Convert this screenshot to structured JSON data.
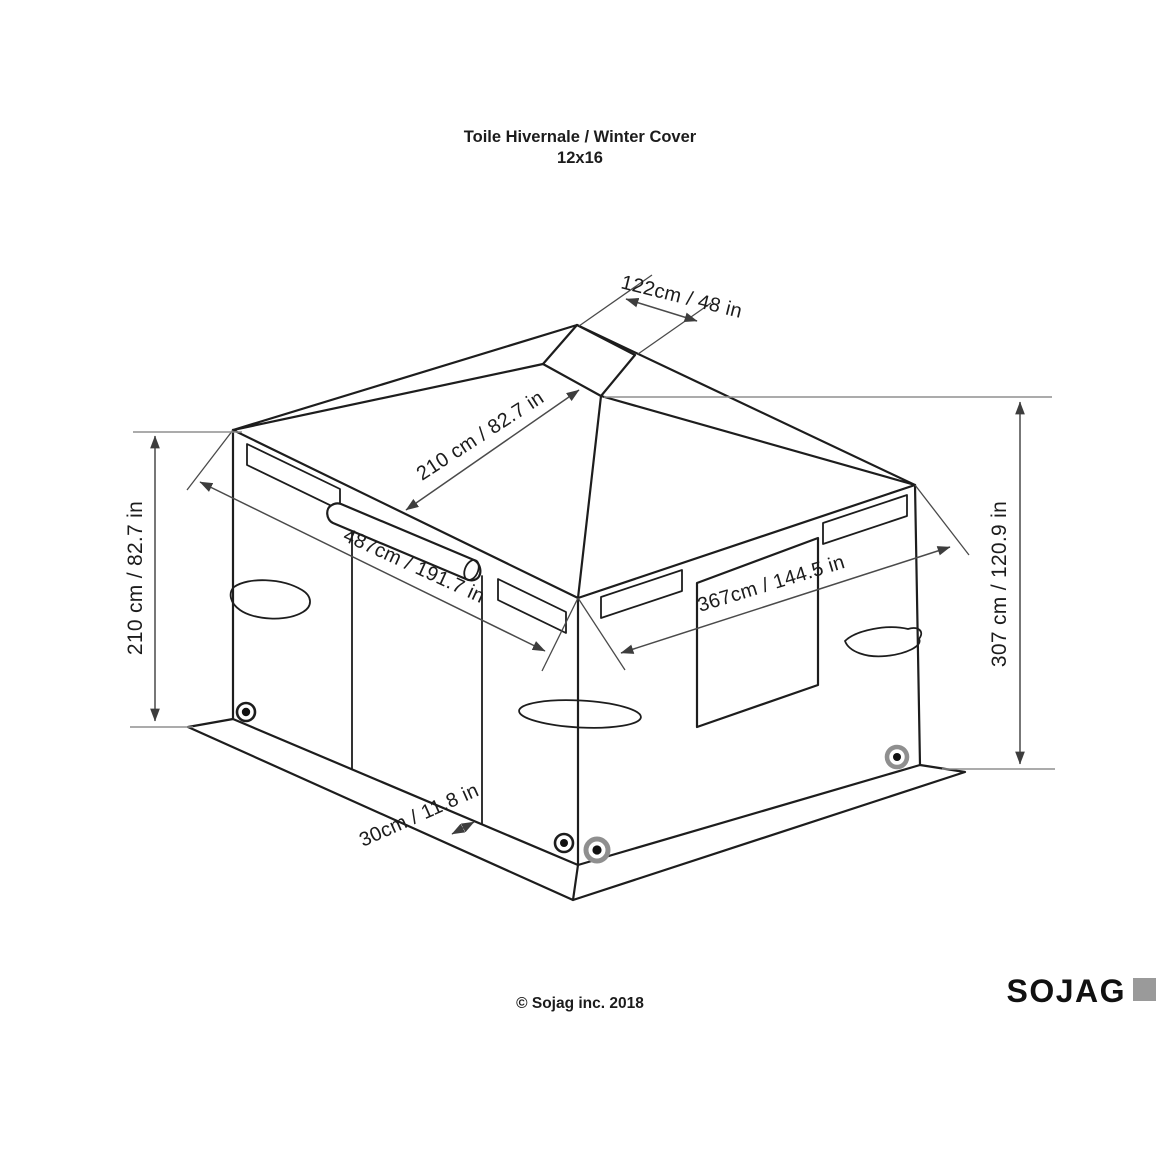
{
  "title": {
    "line1": "Toile Hivernale / Winter Cover",
    "line2": "12x16"
  },
  "diagram": {
    "subject": "gazebo winter cover isometric drawing",
    "dimension_labels": {
      "cap_width": "122cm / 48 in",
      "roof_slope": "210 cm / 82.7 in",
      "front_width": "487cm / 191.7 in",
      "side_width": "367cm / 144.5 in",
      "wall_height": "210 cm / 82.7 in",
      "total_height": "307 cm / 120.9 in",
      "skirt_height": "30cm / 11.8 in"
    }
  },
  "footer": {
    "copyright": "© Sojag inc. 2018"
  },
  "brand": {
    "logo_text": "SOJAG"
  },
  "colors": {
    "background": "#ffffff",
    "line": "#1d1d1d",
    "dimension_line": "#4a4a4a",
    "extension_line": "#8f8f8f",
    "text": "#1c1c1c",
    "logo_square": "#9a9a9a",
    "grommet_ring_gray": "#8f8f8f"
  }
}
